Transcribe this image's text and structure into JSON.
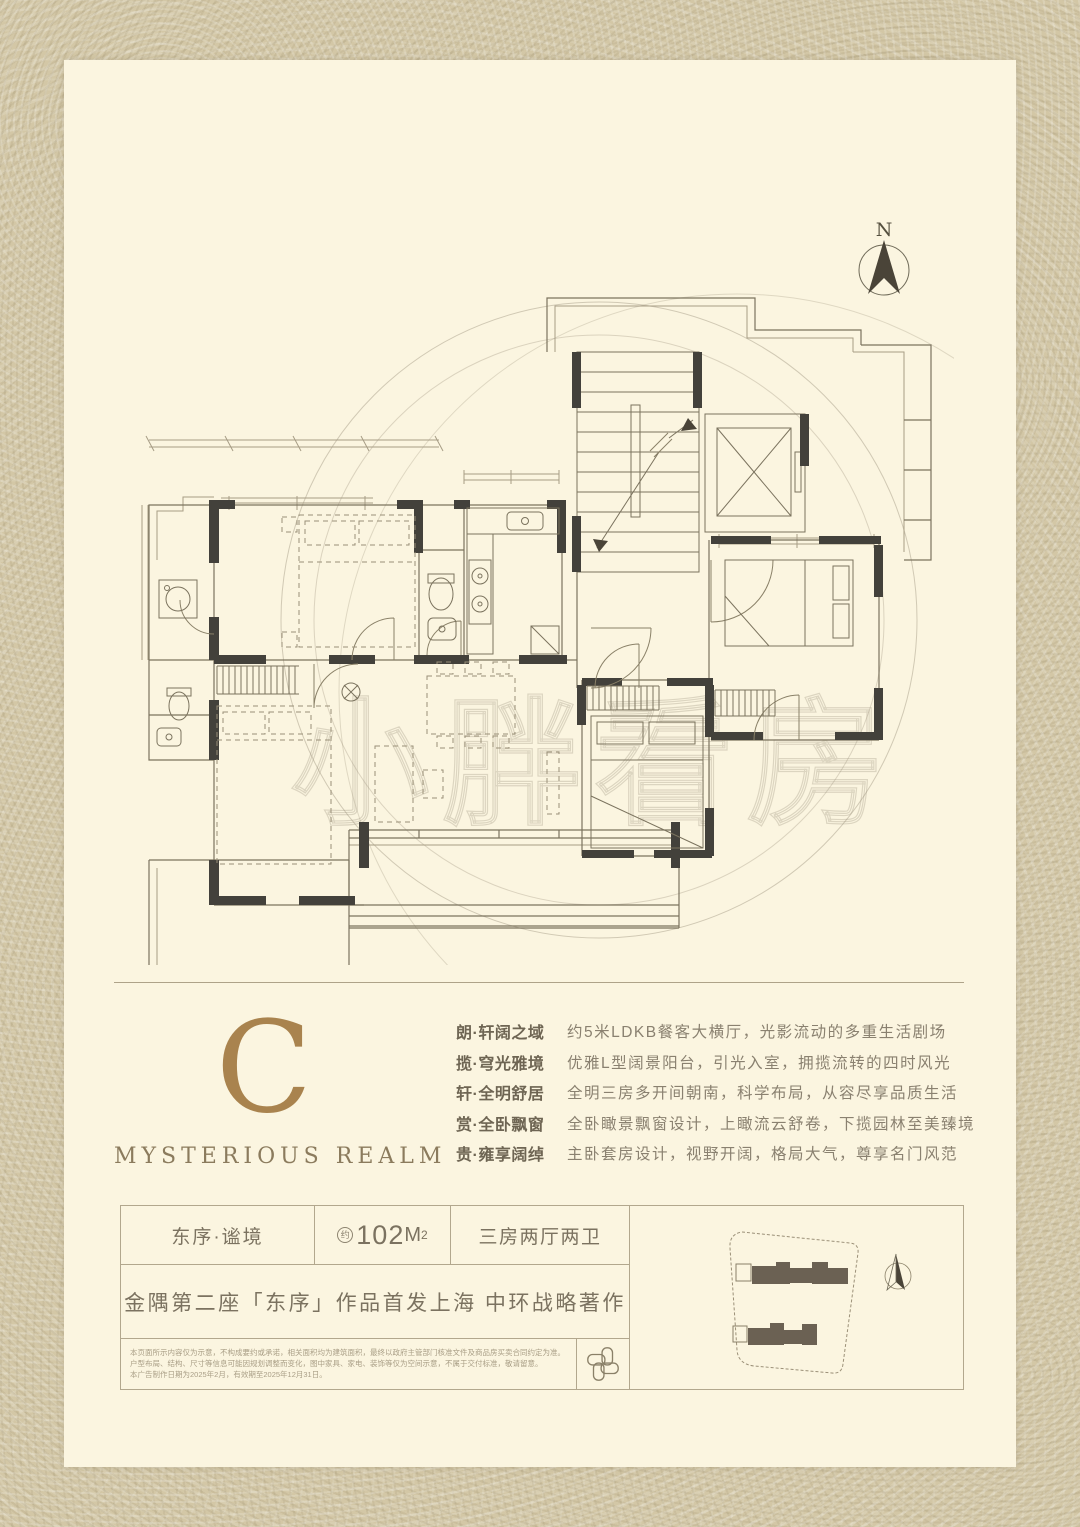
{
  "plan": {
    "compass_label": "N",
    "watermark_text": "小胖看房"
  },
  "unit_card": {
    "letter": "C",
    "subtitle": "MYSTERIOUS REALM"
  },
  "features": [
    {
      "label": "朗·轩阔之域",
      "desc": "约5米LDKB餐客大横厅，光影流动的多重生活剧场"
    },
    {
      "label": "揽·穹光雅境",
      "desc": "优雅L型阔景阳台，引光入室，拥揽流转的四时风光"
    },
    {
      "label": "轩·全明舒居",
      "desc": "全明三房多开间朝南，科学布局，从容尽享品质生活"
    },
    {
      "label": "赏·全卧飘窗",
      "desc": "全卧瞰景飘窗设计，上瞰流云舒卷，下揽园林至美臻境"
    },
    {
      "label": "贵·雍享阔绰",
      "desc": "主卧套房设计，视野开阔，格局大气，尊享名门风范"
    }
  ],
  "info_table": {
    "name": "东序·谧境",
    "area_approx": "约",
    "area_value": "102",
    "area_unit": "M",
    "area_exp": "2",
    "layout": "三房两厅两卫",
    "slogan": "金隅第二座「东序」作品首发上海 中环战略著作",
    "disclaimer_lines": [
      "本页面所示内容仅为示意，不构成要约或承诺，相关面积均为建筑面积，最终以政府主管部门核准文件及商品房买卖合同约定为准。",
      "户型布局、结构、尺寸等信息可能因规划调整而变化，图中家具、家电、装饰等仅为空间示意，不属于交付标准，敬请留意。",
      "本广告制作日期为2025年2月，有效期至2025年12月31日。"
    ]
  },
  "colors": {
    "page_bg": "#fbf5e0",
    "frame_tan": "#d3c7a6",
    "accent_gold": "#a9834e",
    "plan_line": "#7b735e",
    "wall_dark": "#43413b",
    "text_brown": "#7b7260",
    "building_fill": "#6b6153"
  }
}
